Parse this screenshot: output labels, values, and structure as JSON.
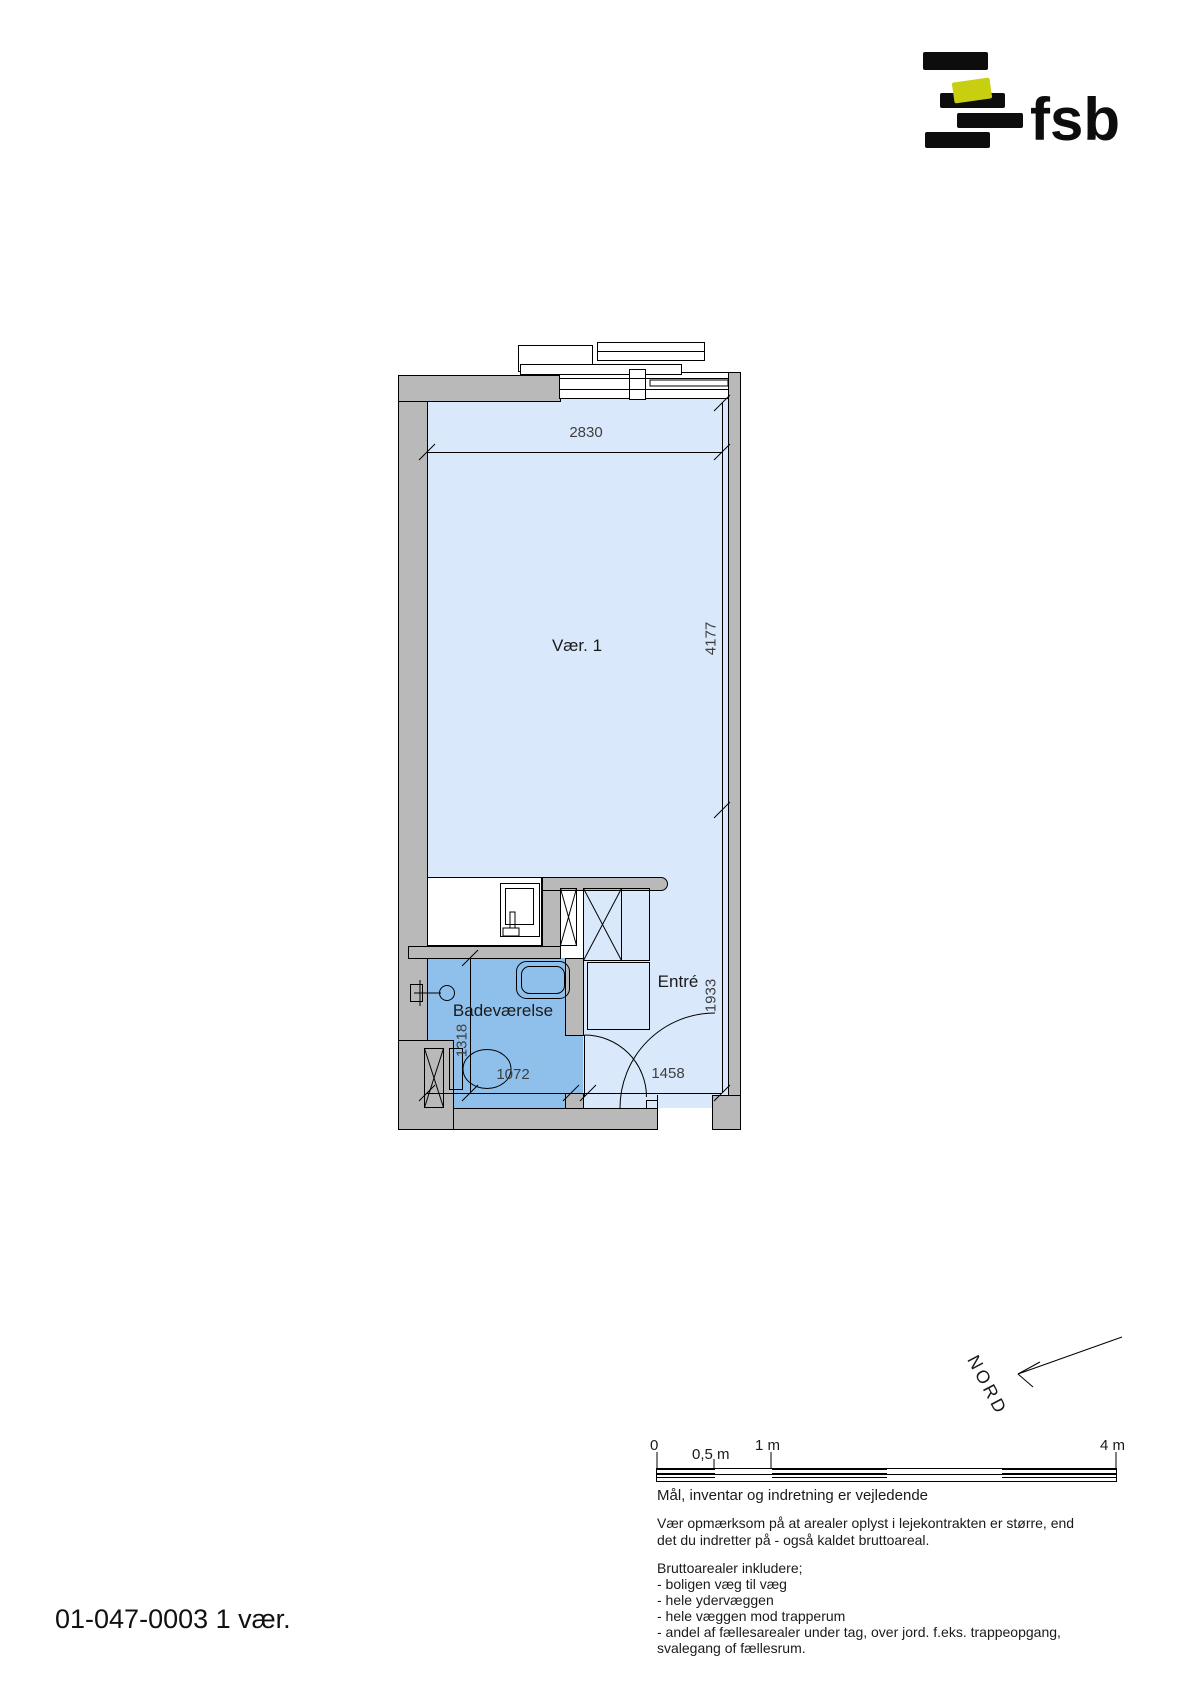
{
  "logo": {
    "text": "fsb",
    "bar_color": "#0d0d0d",
    "accent_color": "#c8ce10"
  },
  "plan": {
    "room_labels": {
      "main": "Vær. 1",
      "bathroom": "Badeværelse",
      "entry": "Entré"
    },
    "dimensions": {
      "top_width": "2830",
      "main_height": "4177",
      "entry_height": "1933",
      "bathroom_height": "1318",
      "bathroom_width": "1072",
      "entry_width": "1458"
    },
    "colors": {
      "room_fill": "#d9e9fb",
      "bathroom_fill": "#8fc0eb",
      "wall_fill": "#b9b9b9",
      "outline": "#000000",
      "dim_color": "#3f3f3f"
    }
  },
  "compass": {
    "label": "NORD"
  },
  "scale_bar": {
    "labels": [
      "0",
      "0,5 m",
      "1 m",
      "4 m"
    ]
  },
  "notes": {
    "line1": "Mål, inventar og indretning er vejledende",
    "line2": "Vær opmærksom på at arealer oplyst i lejekontrakten er større, end",
    "line3": "det du indretter på - også kaldet bruttoareal.",
    "line4": "Bruttoarealer inkludere;",
    "bullets": [
      "- boligen væg til væg",
      "- hele ydervæggen",
      "- hele væggen mod trapperum",
      "- andel af fællesarealer under tag, over jord. f.eks. trappeopgang,",
      "svalegang of fællesrum."
    ]
  },
  "title": {
    "text": "01-047-0003 1 vær."
  }
}
